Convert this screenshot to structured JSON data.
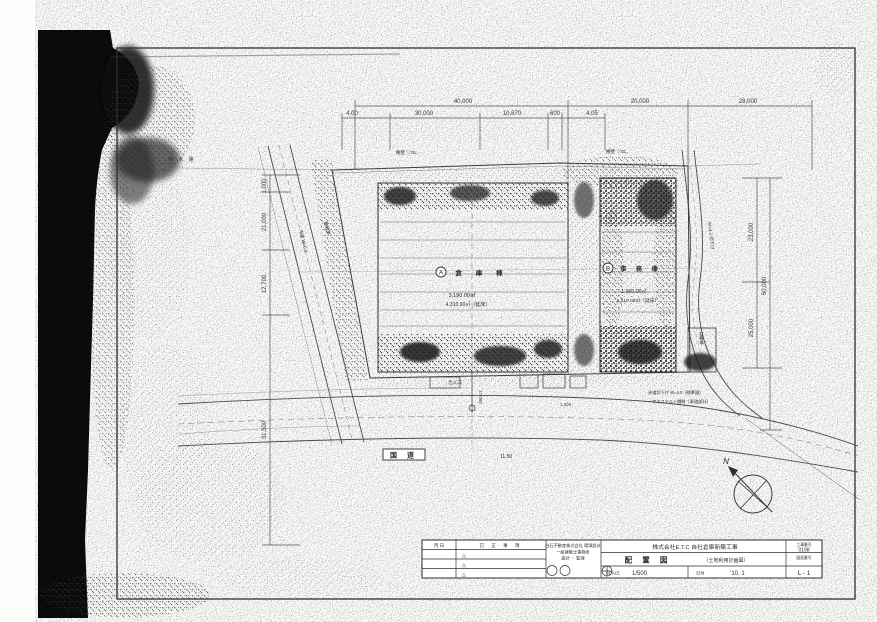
{
  "drawing": {
    "north_label": "N",
    "road": {
      "label": "国 道",
      "width": "11,50"
    },
    "buildings": {
      "a": {
        "mark": "A",
        "name": "倉 庫 棟",
        "area1": "3,190.00㎡",
        "area2": "4,310.00㎡（延床）"
      },
      "b": {
        "mark": "B",
        "name": "事 務 棟",
        "area1": "1,960.00㎡",
        "area2": "2,310.00㎡（延床）"
      }
    },
    "dims": {
      "top1": [
        "40,000",
        "20,000",
        "28,000"
      ],
      "top2": [
        "4,00",
        "30,000",
        "10,870",
        "600",
        "4,05"
      ],
      "left": [
        "1,000",
        "21,000",
        "12,700",
        "31,500"
      ],
      "right": [
        "23,000",
        "50,000",
        "25,000"
      ],
      "bottom": [
        "17,000",
        "1,500"
      ]
    },
    "annotations": {
      "drain": "排 水 路",
      "wall_left": "擁壁 ▽GL",
      "wall_right": "擁壁 ▽GL",
      "planting": "植栽帯",
      "side_road": "市道 W=6.0",
      "right_road": "W=4.2 切下げ",
      "curb": "歩道切下げ W=4.0（標準図）",
      "paving": "アスファルト舗装（車道部分）",
      "entrance": "出入口",
      "bike": "駐輪場"
    }
  },
  "title_block": {
    "date_header": "月 日",
    "revision_header": "訂 正 事 項",
    "rev_marks": [
      "△",
      "△",
      "△"
    ],
    "company_lines": [
      "白石不動産株式会社 環境設計",
      "一級建築士事務所",
      "設計 ・ 監理"
    ],
    "project_title": "株式会社E.T.C 自社倉庫新築工事",
    "drawing_title": "配 置 図",
    "drawing_subtitle": "（土地利用計画図）",
    "scale_label": "SCALE",
    "scale_value": "1/500",
    "date_label": "日付",
    "date_value": "’10. 1",
    "job_no_label": "工事番号",
    "job_no": "0198",
    "sheet_no_label": "図面番号",
    "sheet_no": "L - 1"
  }
}
